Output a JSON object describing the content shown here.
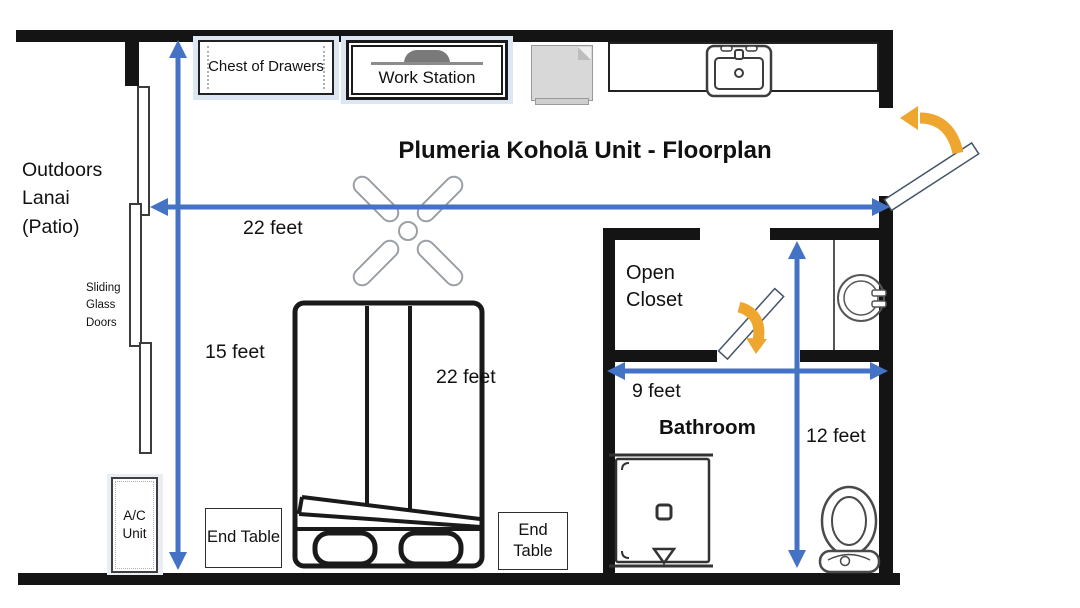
{
  "title": "Plumeria Koholā Unit - Floorplan",
  "colors": {
    "wall": "#141414",
    "dimension_arrow_blue": "#4472c4",
    "door_swing_orange": "#efa62f",
    "furniture_highlight": "#dce7f3"
  },
  "left_side": {
    "area_label": "Outdoors Lanai (Patio)",
    "sliding_doors_label": "Sliding Glass Doors",
    "ac_unit_label": "A/C Unit"
  },
  "top_furniture": {
    "chest_label": "Chest of Drawers",
    "workstation_label": "Work Station"
  },
  "bedroom": {
    "end_tables": [
      "End Table",
      "End Table"
    ],
    "bed_wall_measurement": "22 feet"
  },
  "rooms": {
    "open_closet_label": "Open Closet",
    "bathroom_label": "Bathroom"
  },
  "measurements": {
    "room_width": "22 feet",
    "room_depth": "15 feet",
    "bathroom_width": "9 feet",
    "bathroom_depth": "12 feet"
  }
}
